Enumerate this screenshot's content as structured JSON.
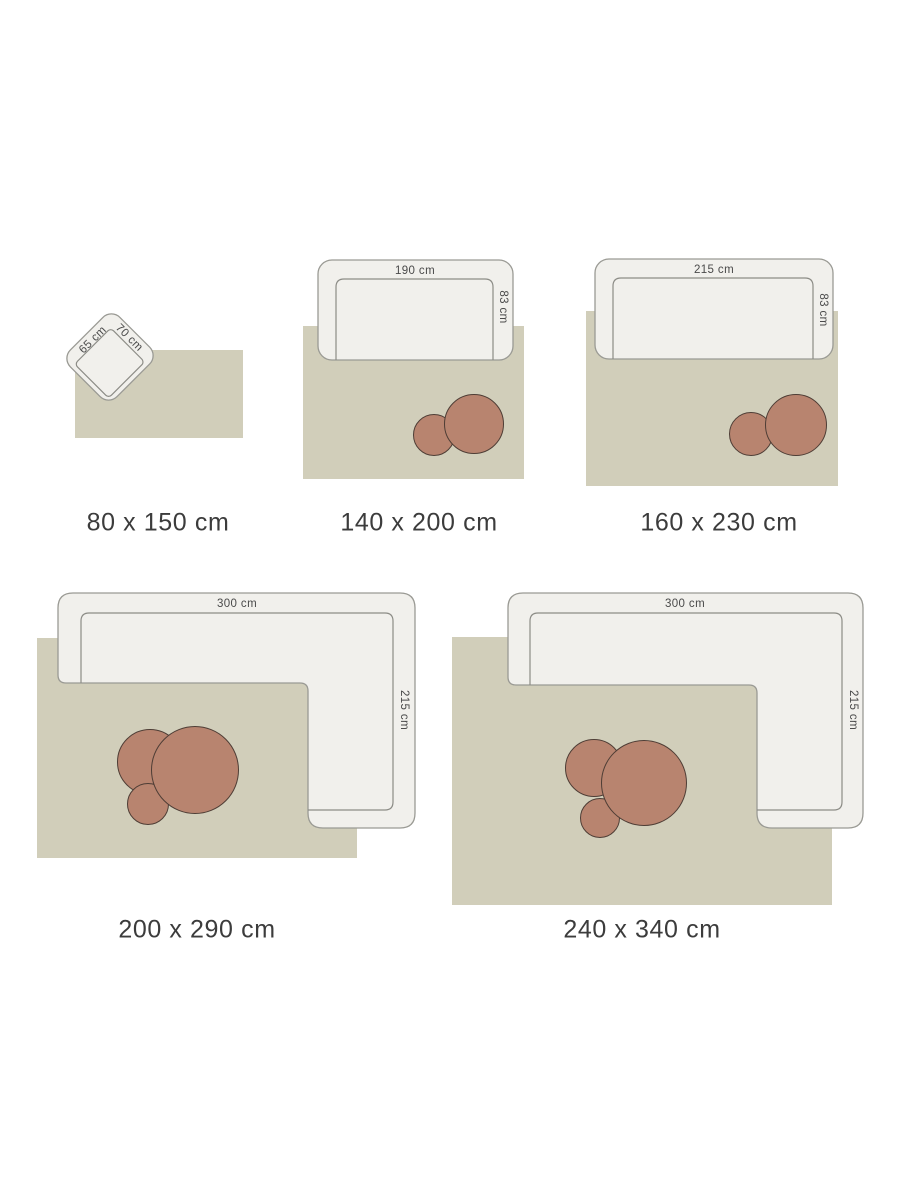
{
  "colors": {
    "background": "#ffffff",
    "rug": "#d1ceba",
    "sofa_fill": "#f1f0ec",
    "sofa_stroke": "#9a9a94",
    "seat_stroke": "#8c8c86",
    "table_fill": "#b8846f",
    "table_stroke": "#4e3d35",
    "caption_text": "#3c3c3c",
    "dimension_text": "#4a4a4a"
  },
  "panels": [
    {
      "caption": "80 x 150 cm",
      "furniture": {
        "type": "armchair",
        "side_label": "65 cm",
        "front_label": "70 cm"
      }
    },
    {
      "caption": "140 x 200 cm",
      "furniture": {
        "type": "sofa",
        "width_label": "190 cm",
        "depth_label": "83 cm"
      }
    },
    {
      "caption": "160 x 230 cm",
      "furniture": {
        "type": "sofa",
        "width_label": "215 cm",
        "depth_label": "83 cm"
      }
    },
    {
      "caption": "200 x 290 cm",
      "furniture": {
        "type": "corner-sofa",
        "width_label": "300 cm",
        "depth_label": "215 cm"
      }
    },
    {
      "caption": "240 x 340 cm",
      "furniture": {
        "type": "corner-sofa",
        "width_label": "300 cm",
        "depth_label": "215 cm"
      }
    }
  ]
}
